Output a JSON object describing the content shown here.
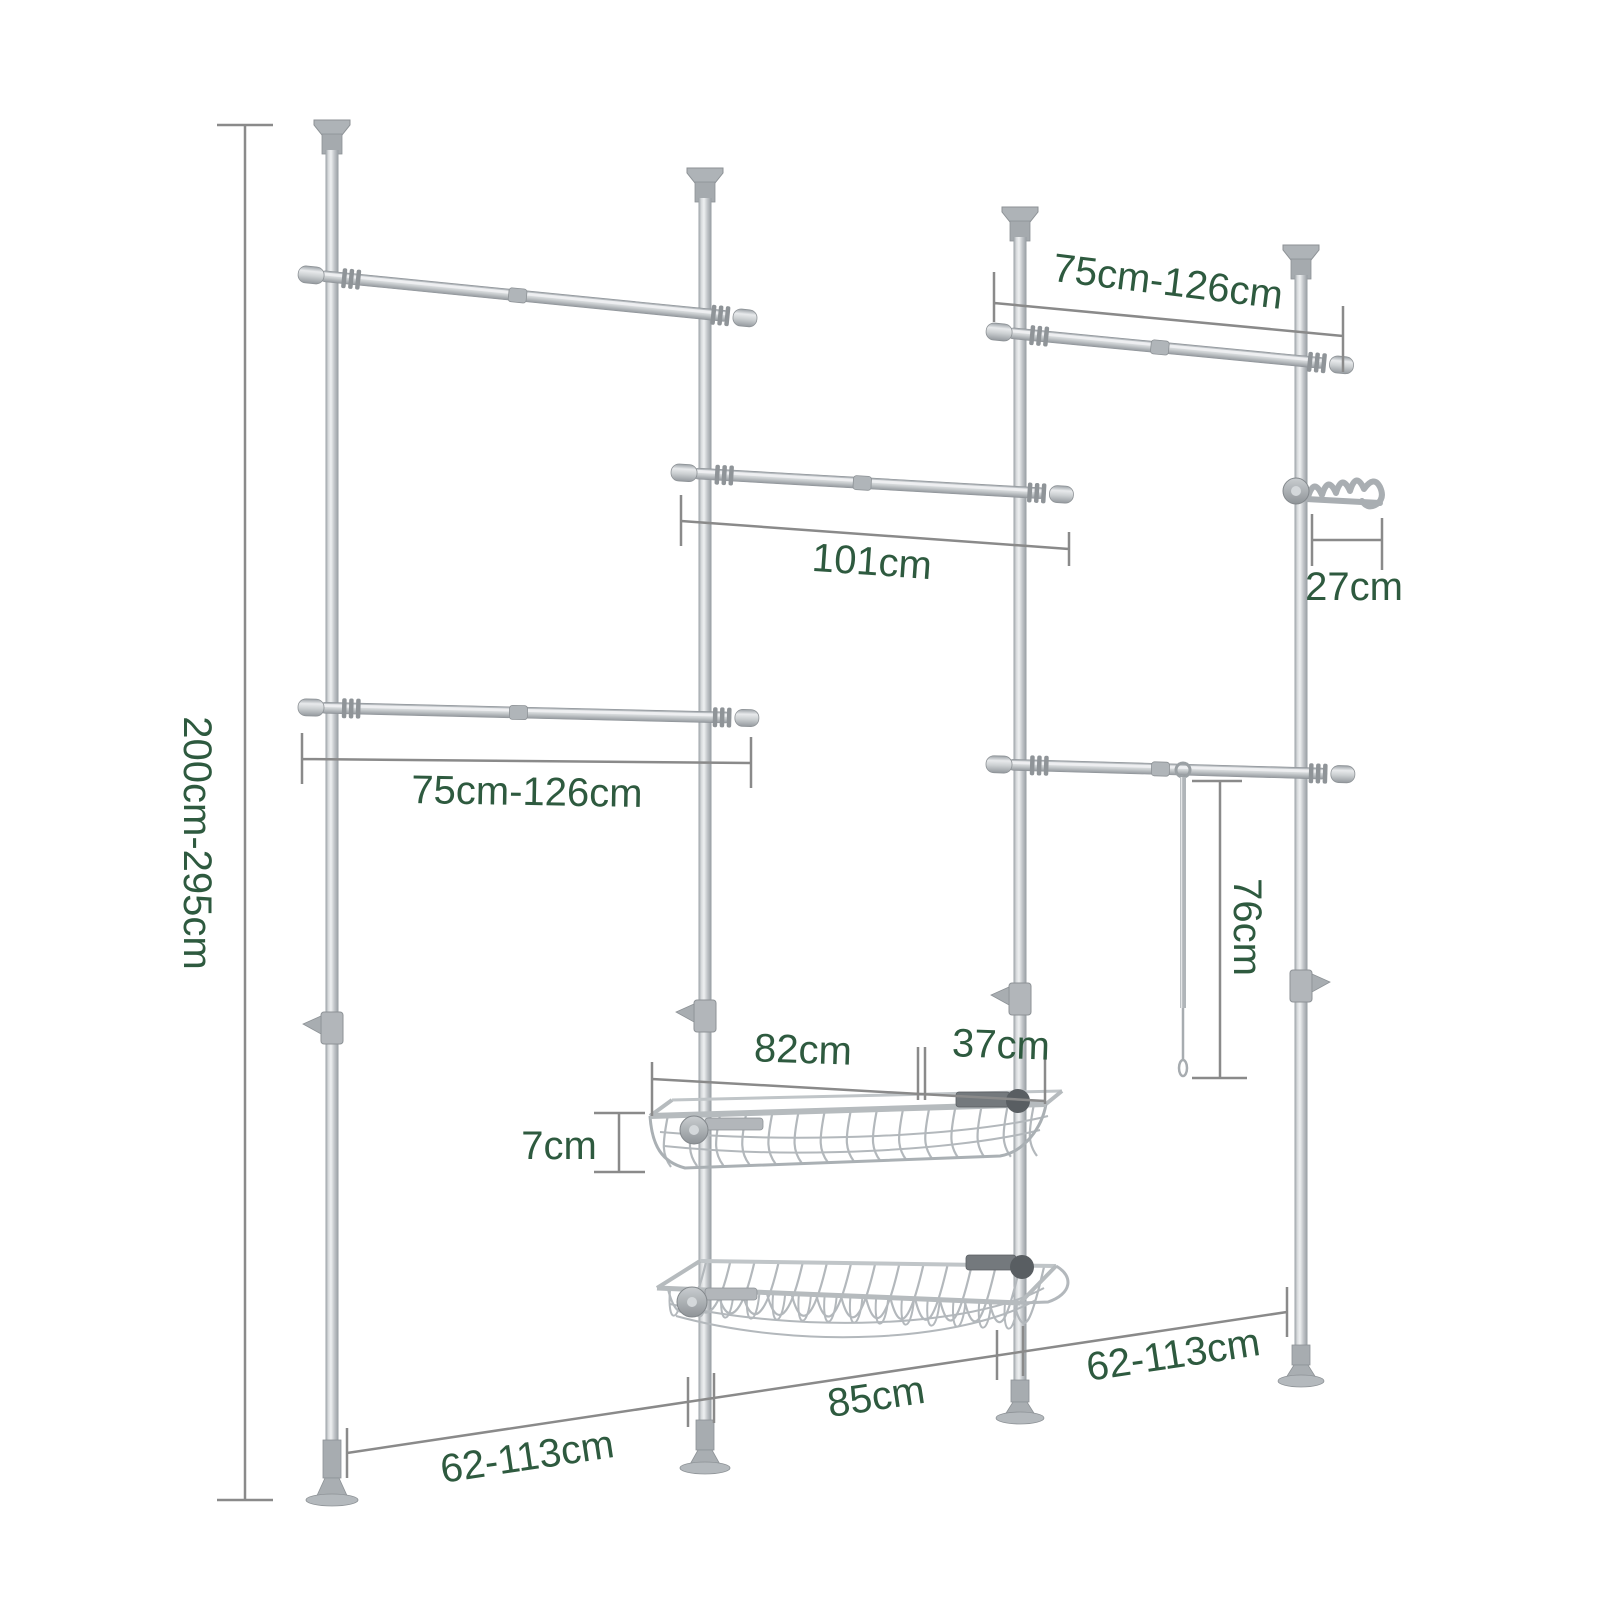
{
  "diagram": {
    "colors": {
      "label_text": "#2e5a3f",
      "dimension_line": "#8a8a8a",
      "metal_highlight": "#eef0f1",
      "metal_mid": "#c3c7ca",
      "metal_shadow": "#9aa0a5",
      "fitting_dark": "#595e62",
      "background": "#ffffff"
    },
    "annotations": {
      "overall_height": "200cm-295cm",
      "rail_top_right": "75cm-126cm",
      "rail_middle": "101cm",
      "hook_rack": "27cm",
      "rail_middle_left": "75cm-126cm",
      "hanging_rod": "76cm",
      "basket_length": "82cm",
      "basket_depth": "37cm",
      "basket_height": "7cm",
      "floor_span_left": "62-113cm",
      "floor_span_middle": "85cm",
      "floor_span_right": "62-113cm"
    }
  }
}
